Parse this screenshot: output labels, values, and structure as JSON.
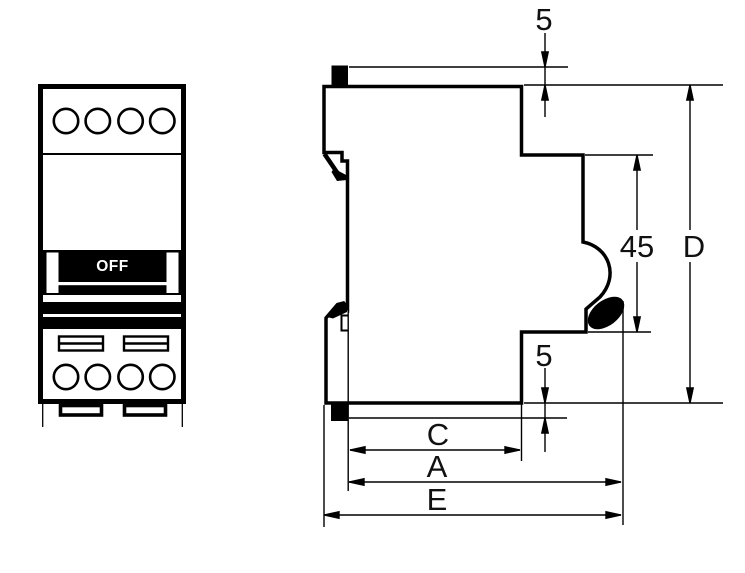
{
  "front_view": {
    "off_label": "OFF"
  },
  "dimensions": {
    "top_clearance": "5",
    "handle_recess_height": "45",
    "overall_height": "D",
    "bottom_clearance": "5",
    "width_c": "C",
    "width_a": "A",
    "width_e": "E"
  },
  "colors": {
    "line": "#000000",
    "background": "#ffffff"
  }
}
